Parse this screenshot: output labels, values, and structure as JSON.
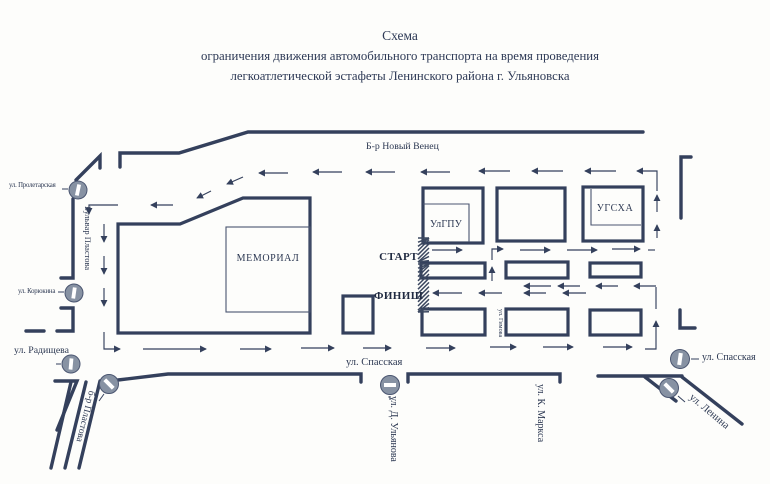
{
  "title": {
    "line1": "Схема",
    "line2": "ограничения движения автомобильного транспорта на время проведения",
    "line3": "легкоатлетической эстафеты Ленинского района г. Ульяновска"
  },
  "map": {
    "streets": {
      "novy_venets": "Б-р Новый Венец",
      "proletarskaya": "ул. Пролетарская",
      "bulvar_plastova": "Бульвар Пластова",
      "koryukina": "ул. Корюкина",
      "radishcheva": "ул. Радищева",
      "spasskaya_center": "ул. Спасская",
      "spasskaya_right": "ул. Спасская",
      "gimova": "ул. Гимова",
      "plastova_diagonal": "б-р Пластова",
      "d_ulyanova": "ул. Д. Ульянова",
      "k_marksa": "ул. К. Маркса",
      "lenina": "ул. Ленина"
    },
    "buildings": {
      "memorial": "МЕМОРИАЛ",
      "ulgpu": "УлГПУ",
      "ugsha": "УГСХА"
    },
    "markers": {
      "start": "СТАРТ",
      "finish": "ФИНИШ"
    },
    "colors": {
      "ink": "#34405c",
      "sign_fill": "#8792a3",
      "text": "#2c3852"
    }
  }
}
